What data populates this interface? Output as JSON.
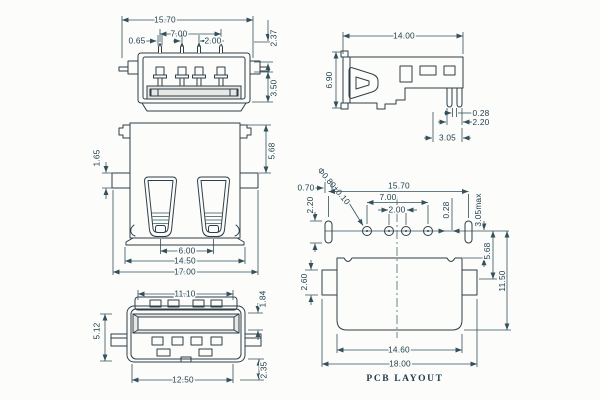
{
  "drawing_caption": "PCB LAYOUT",
  "colors": {
    "line": "#2e3e48",
    "dim_line": "#33505c",
    "text": "#1c3d4c",
    "background": "#fcfcfa",
    "shade": "#e7e7e3"
  },
  "views": {
    "rear_view": {
      "dims": {
        "overall_width": "15.70",
        "contact_span": "7.00",
        "contact_width": "0.65",
        "contact_pitch": "2.00",
        "tail_height": "2.37",
        "lower_height": "3.50"
      }
    },
    "front_view": {
      "dims": {
        "flange_thickness": "1.65",
        "top_to_flange": "5.68",
        "slot_spacing": "6.00",
        "base_width": "14.50",
        "overall_width": "17.00"
      }
    },
    "plug_face_view": {
      "dims": {
        "opening_width": "11.10",
        "opening_height": "1.84",
        "overall_height": "5.12",
        "shell_width": "12.50",
        "foot_height": "2.35"
      }
    },
    "side_view": {
      "dims": {
        "overall_depth": "14.00",
        "overall_height": "6.90",
        "lead_thickness": "0.28",
        "lead_span": "2.20",
        "lead_offset": "3.05"
      }
    },
    "pcb_layout": {
      "caption": "PCB LAYOUT",
      "dims": {
        "slot_pad_width": "0.70",
        "slot_pad_height": "2.20",
        "hole_spec": "Φ0.80±0.10",
        "slot_pad_span": "15.70",
        "hole_span": "7.00",
        "hole_pitch": "2.00",
        "hole_offset": "0.28",
        "row_to_body_edge": "3.05max",
        "row_to_side_pad": "5.68",
        "row_to_bottom_edge": "11.50",
        "side_pad_height": "2.60",
        "body_width": "14.60",
        "overall_width": "18.00"
      }
    }
  }
}
